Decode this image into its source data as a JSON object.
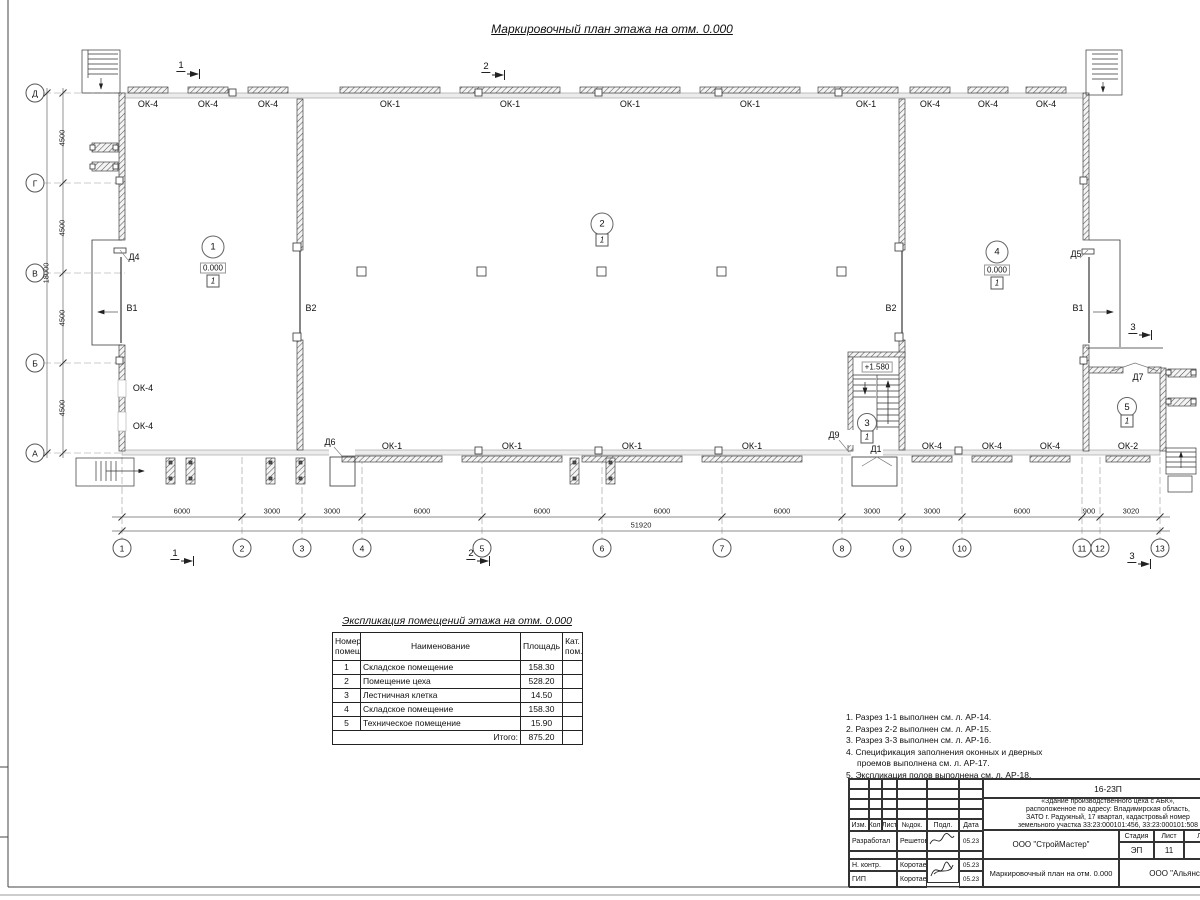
{
  "sheet_title": "Маркировочный план этажа на отм. 0.000",
  "plan": {
    "axes_h": [
      "1",
      "2",
      "3",
      "4",
      "5",
      "6",
      "7",
      "8",
      "9",
      "10",
      "11",
      "12",
      "13"
    ],
    "axes_v": [
      "Д",
      "Г",
      "В",
      "Б",
      "А"
    ],
    "dims_h": [
      "6000",
      "3000",
      "3000",
      "6000",
      "6000",
      "6000",
      "6000",
      "3000",
      "3000",
      "6000",
      "900",
      "3020"
    ],
    "total_width": "51920",
    "dims_v": [
      "4500",
      "4500",
      "4500",
      "4500"
    ],
    "total_height": "18000",
    "win_top": [
      "ОК-4",
      "ОК-4",
      "ОК-4",
      "ОК-1",
      "ОК-1",
      "ОК-1",
      "ОК-1",
      "ОК-1",
      "ОК-4",
      "ОК-4",
      "ОК-4"
    ],
    "win_bottom": [
      "ОК-1",
      "ОК-1",
      "ОК-1",
      "ОК-1",
      "ОК-4",
      "ОК-4",
      "ОК-4",
      "ОК-2"
    ],
    "win_left": [
      "ОК-4",
      "ОК-4"
    ],
    "doors": {
      "d4": "Д4",
      "d5": "Д5",
      "d6": "Д6",
      "d7": "Д7",
      "d9": "Д9",
      "d1": "Д1"
    },
    "gates": {
      "b1_left": "В1",
      "b2_left": "В2",
      "b2_right": "В2",
      "b1_right": "В1"
    },
    "rooms": [
      {
        "num": "1",
        "elev": "0.000",
        "floor": "1"
      },
      {
        "num": "2",
        "floor": "1"
      },
      {
        "num": "3",
        "floor": "1"
      },
      {
        "num": "4",
        "elev": "0.000",
        "floor": "1"
      },
      {
        "num": "5",
        "floor": "1"
      }
    ],
    "landing_elev": "+1.580",
    "sections": {
      "s1": "1",
      "s2": "2",
      "s3": "3"
    }
  },
  "table": {
    "title": "Экспликация помещений этажа на отм. 0.000",
    "headers": {
      "num": "Номер\nпомещ.",
      "name": "Наименование",
      "area": "Площадь",
      "cat": "Кат.\nпом."
    },
    "rows": [
      [
        "1",
        "Складское помещение",
        "158.30"
      ],
      [
        "2",
        "Помещение цеха",
        "528.20"
      ],
      [
        "3",
        "Лестничная клетка",
        "14.50"
      ],
      [
        "4",
        "Складское помещение",
        "158.30"
      ],
      [
        "5",
        "Техническое помещение",
        "15.90"
      ]
    ],
    "total_label": "Итого:",
    "total_value": "875.20"
  },
  "notes": [
    "1. Разрез 1-1 выполнен см. л. АР-14.",
    "2. Разрез 2-2 выполнен см. л. АР-15.",
    "3. Разрез 3-3 выполнен см. л. АР-16.",
    "4. Спецификация заполнения оконных и дверных\nпроемов выполнена см. л. АР-17.",
    "5. Экспликация полов выполнена см. л. АР-18."
  ],
  "titleblock": {
    "doc_number": "16-23П",
    "description": "«Здание производственного цеха с АБК»,\nрасположенное по адресу: Владимирская область,\nЗАТО г. Радужный, 17 квартал, кадастровый номер\nземельного участка 33:23:000101:456, 33:23:000101:508",
    "cols": {
      "izm": "Изм.",
      "kol": "Кол.",
      "list": "Лист",
      "ndok": "№док.",
      "podp": "Подл.",
      "data": "Дата"
    },
    "rows": [
      {
        "role": "Разработал",
        "name": "Решетова",
        "date": "05.23"
      },
      {
        "role": "Н. контр.",
        "name": "Коротаев",
        "date": "05.23"
      },
      {
        "role": "ГИП",
        "name": "Коротаев",
        "date": "05.23"
      }
    ],
    "org": "ООО \"СтройМастер\"",
    "stage_label": "Стадия",
    "sheet_label": "Лист",
    "sheets_label": "Листов",
    "stage": "ЭП",
    "sheet_num": "11",
    "sheets_num": "1",
    "drawing_title": "Маркировочный план на отм. 0.000",
    "client": "ООО \"Альянс\""
  }
}
